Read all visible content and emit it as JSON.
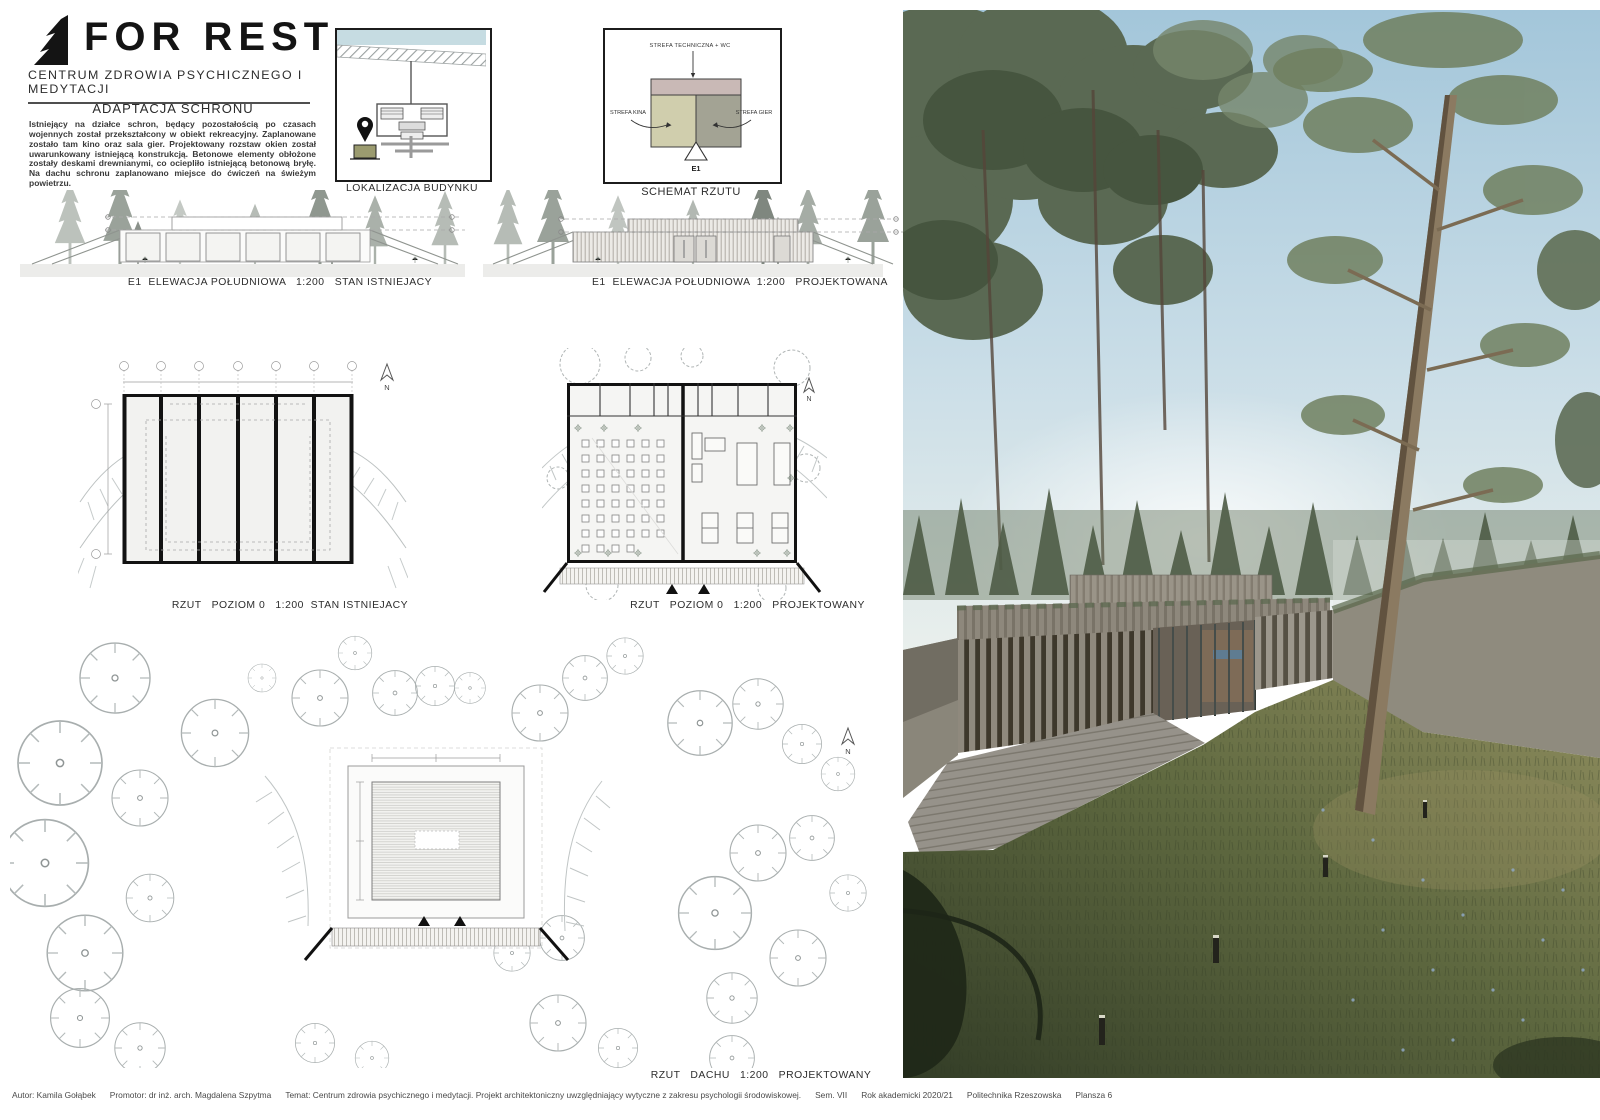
{
  "board": {
    "logo": {
      "title": "FOR REST",
      "subtitle": "CENTRUM ZDROWIA PSYCHICZNEGO I MEDYTACJI"
    },
    "intro": {
      "heading": "ADAPTACJA SCHRONU",
      "body": "Istniejący na działce schron, będący pozostałością po czasach wojennych został przekształcony w obiekt rekreacyjny. Zaplanowane zostało tam kino oraz sala gier. Projektowany rozstaw okien został uwarunkowany istniejącą konstrukcją. Betonowe elementy obłożone zostały deskami drewnianymi, co ociepliło istniejącą betonową bryłę. Na dachu schronu zaplanowano miejsce do ćwiczeń na świeżym powietrzu."
    },
    "location_diagram": {
      "caption": "LOKALIZACJA BUDYNKU"
    },
    "plan_schema": {
      "caption": "SCHEMAT RZUTU",
      "zone_technical": "STREFA TECHNICZNA + WC",
      "zone_cinema": "STREFA KINA",
      "zone_games": "STREFA GIER",
      "elevation_marker": "E1",
      "colors": {
        "technical": "#c9b9b6",
        "cinema": "#d0cead",
        "games": "#a3a394"
      }
    },
    "captions": {
      "elev_existing": "E1  ELEWACJA POŁUDNIOWA   1:200   STAN ISTNIEJACY",
      "elev_designed": "E1  ELEWACJA POŁUDNIOWA  1:200   PROJEKTOWANA",
      "plan_existing": "RZUT   POZIOM 0   1:200  STAN ISTNIEJACY",
      "plan_designed": "RZUT   POZIOM 0   1:200   PROJEKTOWANY",
      "roof_plan": "RZUT   DACHU   1:200   PROJEKTOWANY"
    },
    "north_label": "N"
  },
  "footer": {
    "autor": "Autor: Kamila Gołąbek",
    "promotor": "Promotor: dr inż. arch. Magdalena Szpytma",
    "temat": "Temat: Centrum zdrowia psychicznego i medytacji. Projekt architektoniczny uwzględniający wytyczne z zakresu psychologii środowiskowej.",
    "sem": "Sem. VII",
    "rok": "Rok akademicki 2020/21",
    "uczelnia": "Politechnika Rzeszowska",
    "plansza": "Plansza 6"
  }
}
